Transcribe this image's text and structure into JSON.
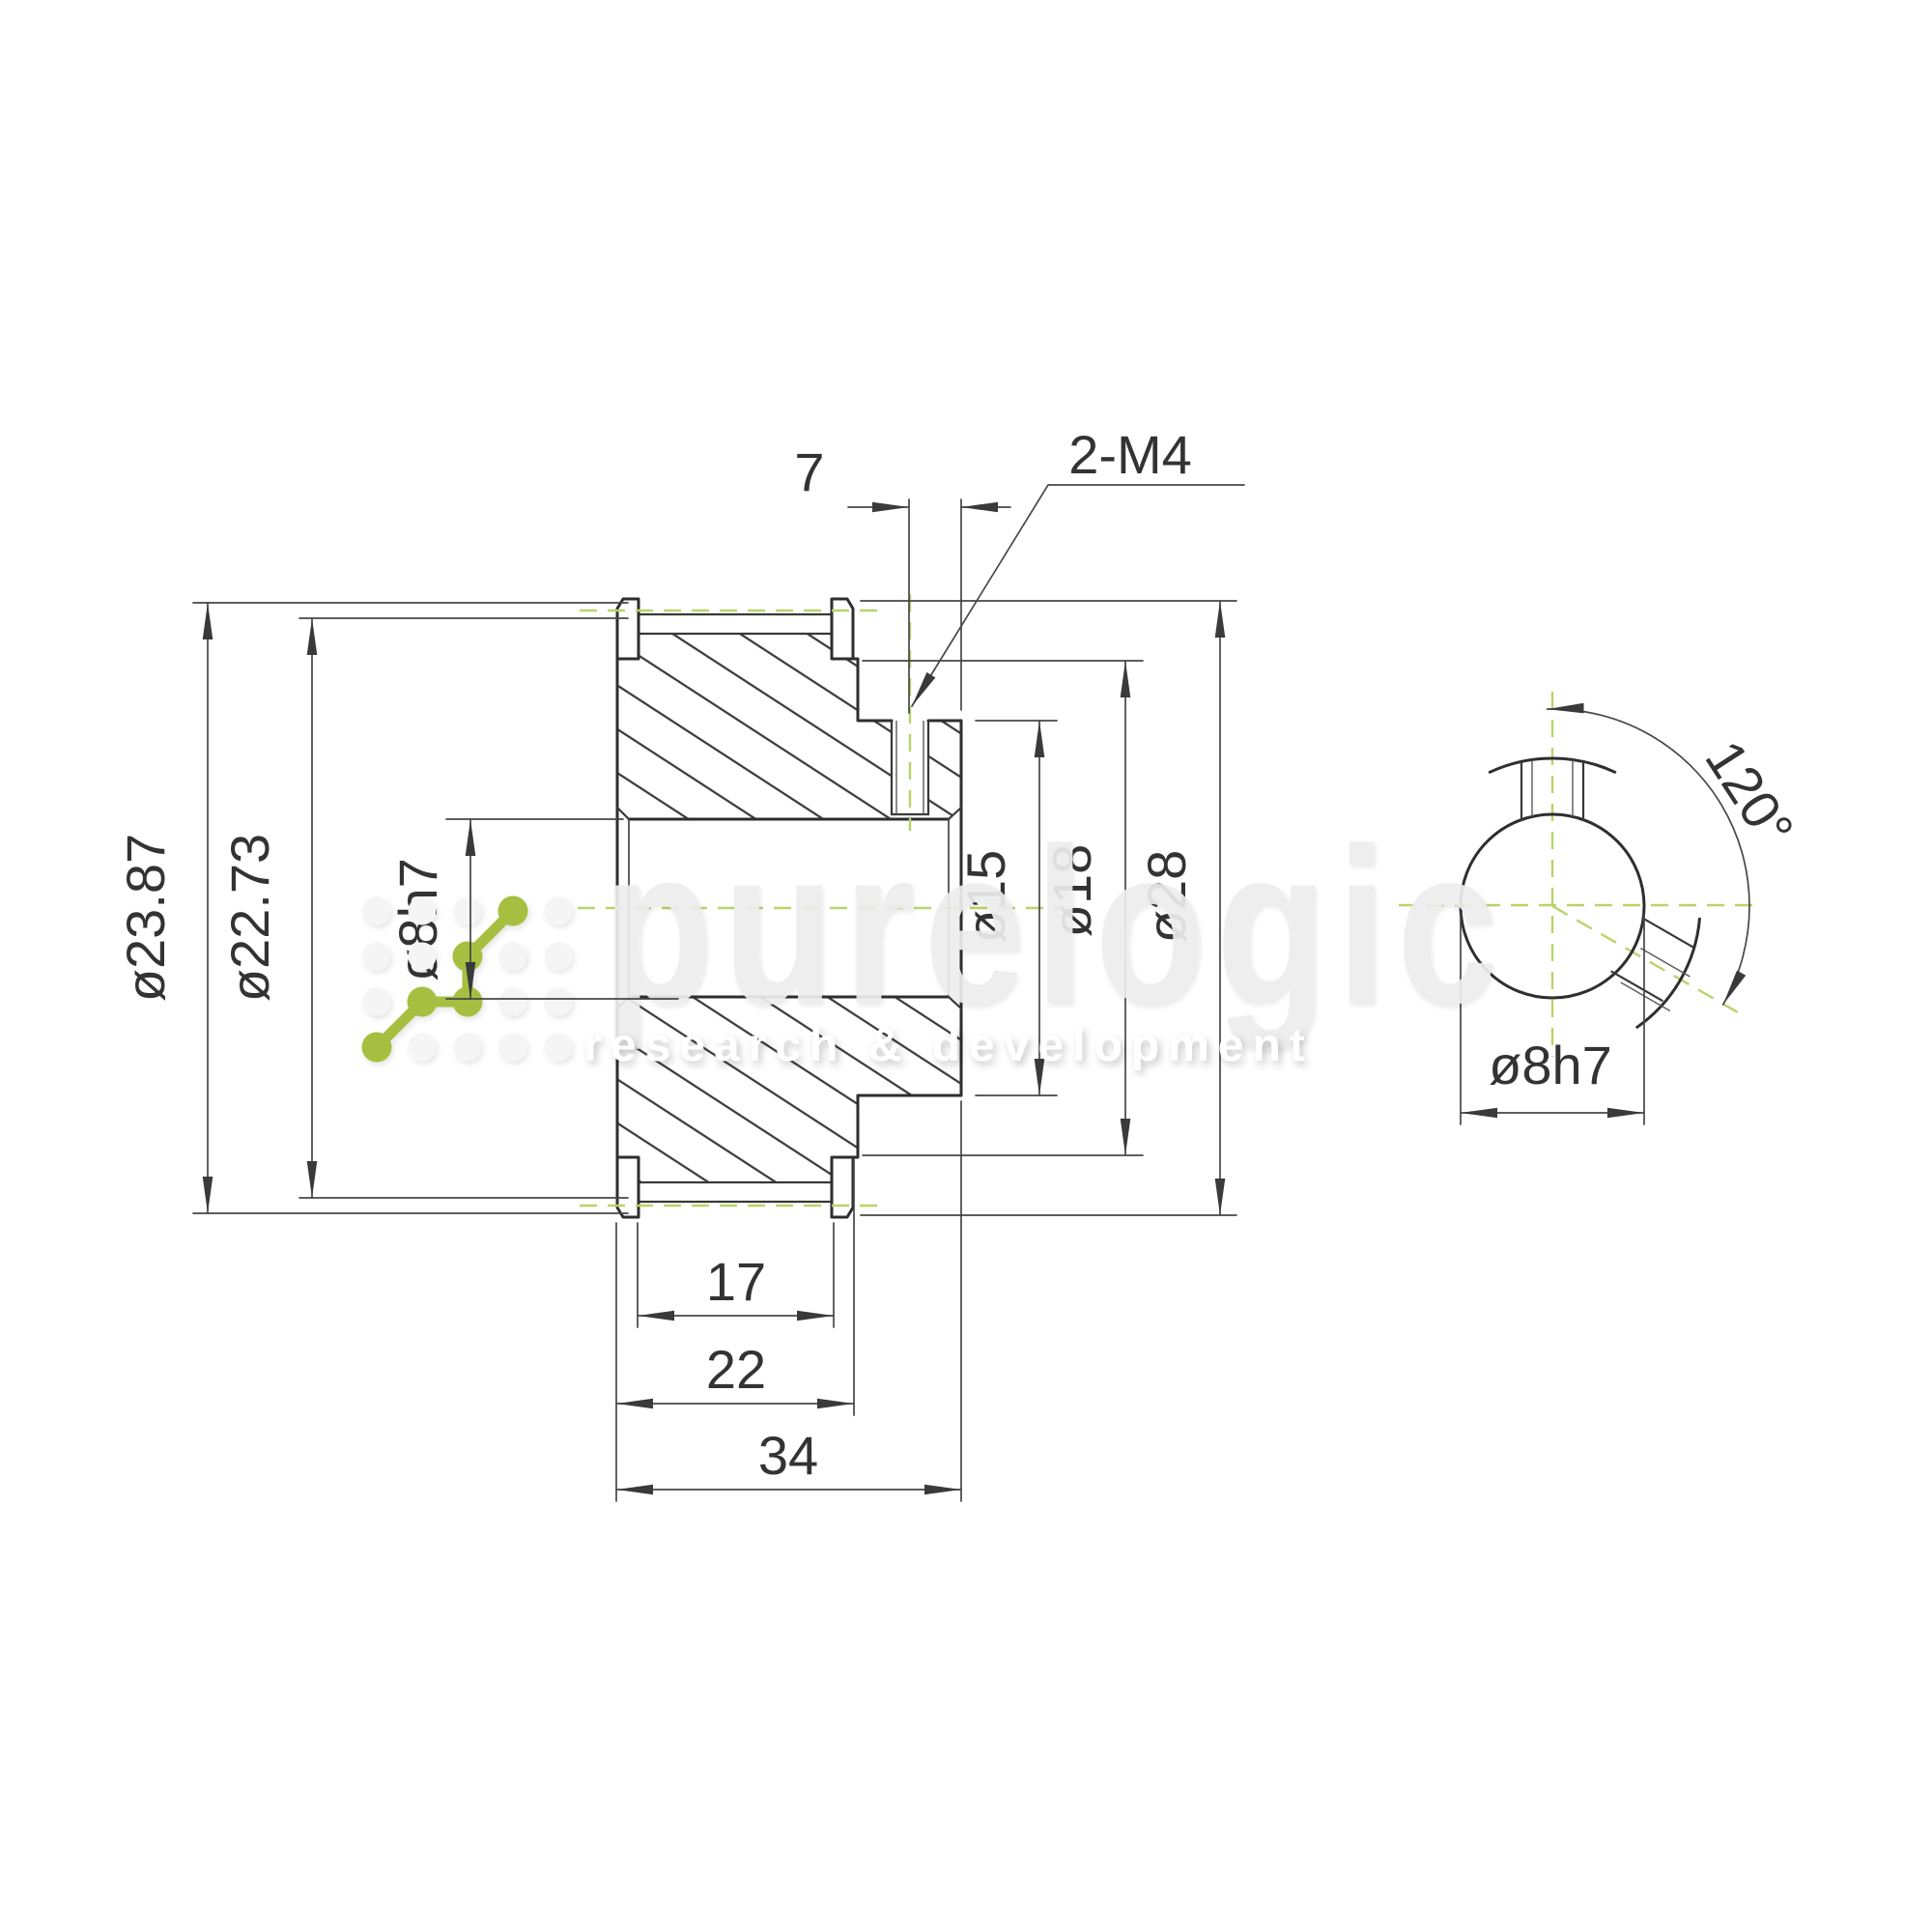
{
  "title": "Timing pulley technical drawing",
  "dims": {
    "flange_od": "ø23.87",
    "tooth_od": "ø22.73",
    "bore_front": "ø8h7",
    "setscrew_offset": "7",
    "setscrew_spec": "2-M4",
    "recess_od": "ø15",
    "hub_od": "ø18",
    "outer_od": "ø28",
    "tooth_width": "17",
    "belt_width": "22",
    "overall_width": "34",
    "setscrew_angle": "120°",
    "bore_end": "ø8h7"
  },
  "watermark": {
    "brand": "purelogic",
    "tagline": "research & development"
  },
  "colors": {
    "background": "#ffffff",
    "line_dark": "#2e2e2e",
    "line_thin": "#474747",
    "centerline_green": "#b9d36a",
    "logo_green": "#a6bf3f",
    "watermark_gray": "#ededed",
    "text": "#333333"
  }
}
